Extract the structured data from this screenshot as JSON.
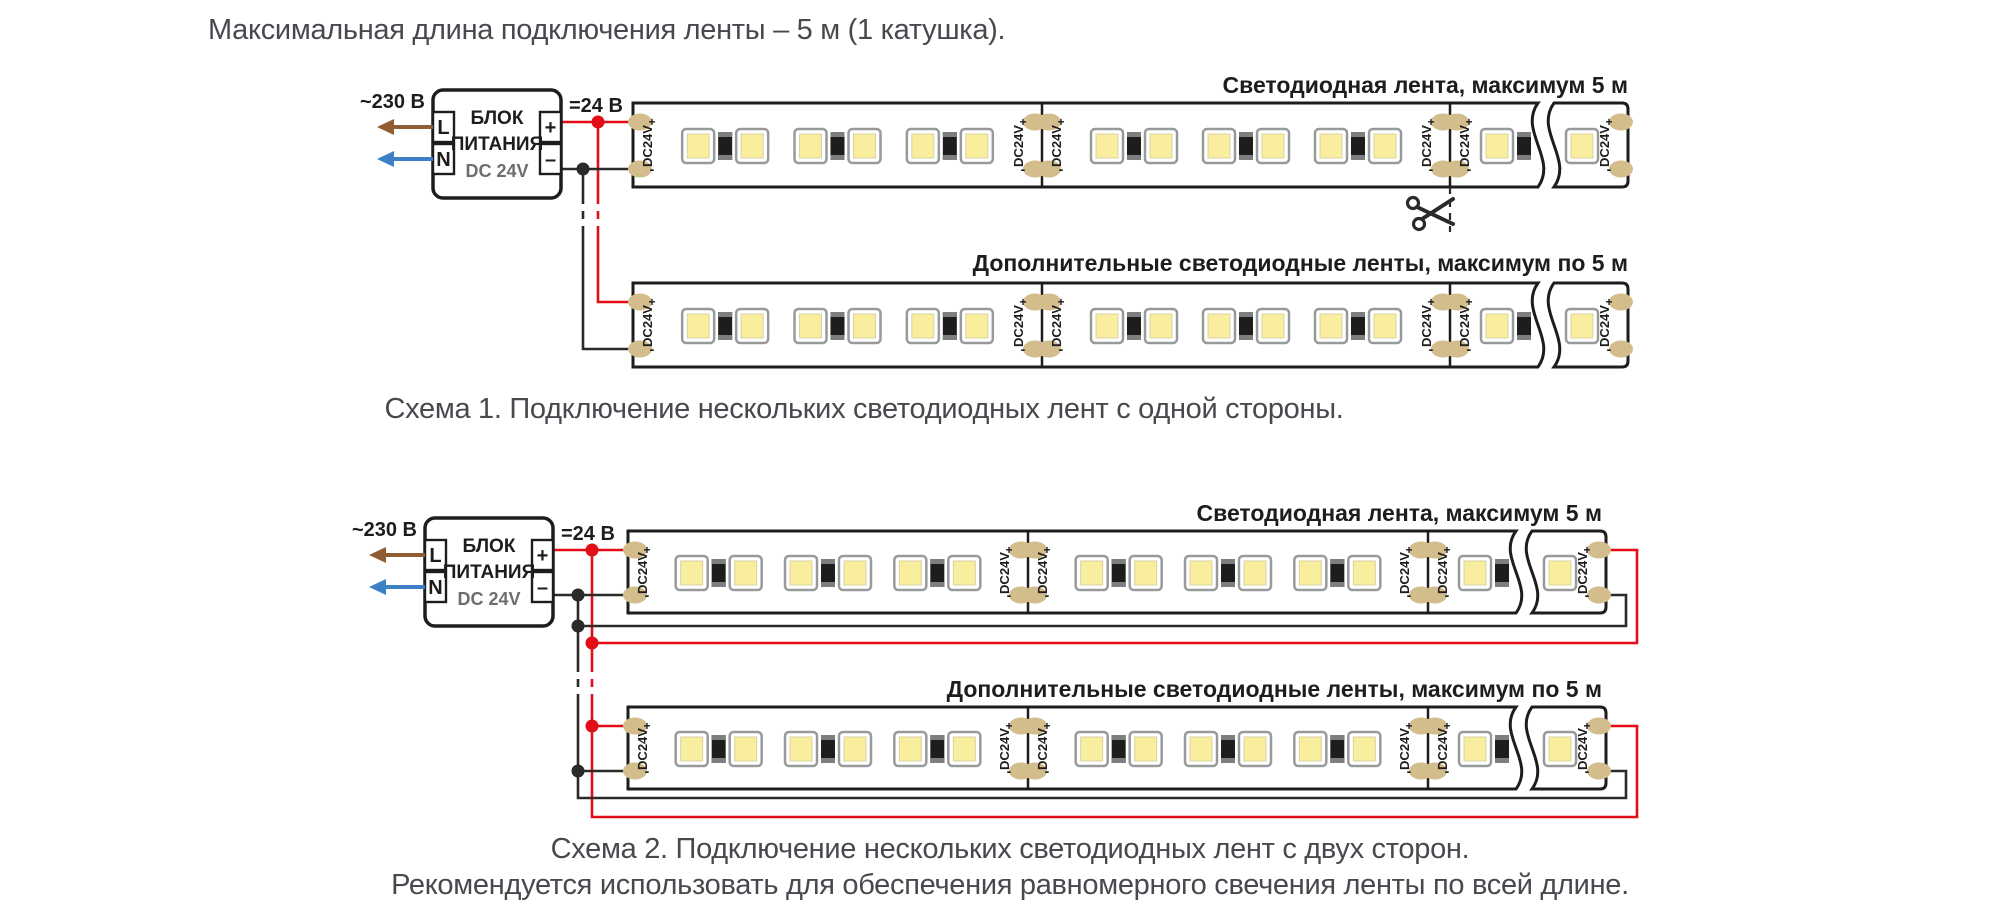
{
  "title": "Максимальная длина подключения ленты – 5 м (1 катушка).",
  "psu": {
    "line1": "БЛОК",
    "line2": "ПИТАНИЯ",
    "line3": "DC 24V",
    "terminal_l": "L",
    "terminal_n": "N",
    "terminal_plus": "+",
    "terminal_minus": "–",
    "input_label": "~230 В",
    "output_label": "=24 В"
  },
  "strip": {
    "connector_label": "DC24V",
    "plus_mark": "+",
    "minus_mark": "-",
    "full_segments": 2,
    "led_clusters_per_segment": 3
  },
  "scheme1": {
    "strip1_label": "Светодиодная лента, максимум 5 м",
    "strip2_label": "Дополнительные светодиодные ленты, максимум по 5 м",
    "caption": "Схема 1. Подключение нескольких светодиодных лент с одной стороны."
  },
  "scheme2": {
    "strip1_label": "Светодиодная лента, максимум 5 м",
    "strip2_label": "Дополнительные светодиодные ленты, максимум по 5 м",
    "caption_line1": "Схема 2. Подключение нескольких светодиодных лент с двух сторон.",
    "caption_line2": "Рекомендуется использовать для обеспечения равномерного свечения ленты по всей длине."
  },
  "colors": {
    "wire_red": "#e30d18",
    "wire_black": "#2b2a29",
    "outline": "#1d1d1b",
    "text_black": "#1d1d1b",
    "text_gray": "#46494e",
    "psu_sub": "#6d6e71",
    "pad": "#d3bd8d",
    "led_yellow": "#f8ee9d",
    "led_frame_stroke": "#97999b",
    "resistor_body": "#1d1d1b",
    "resistor_cap": "#7c7e80",
    "arrow_brown": "#8e5d33",
    "arrow_blue": "#3c80c6"
  }
}
